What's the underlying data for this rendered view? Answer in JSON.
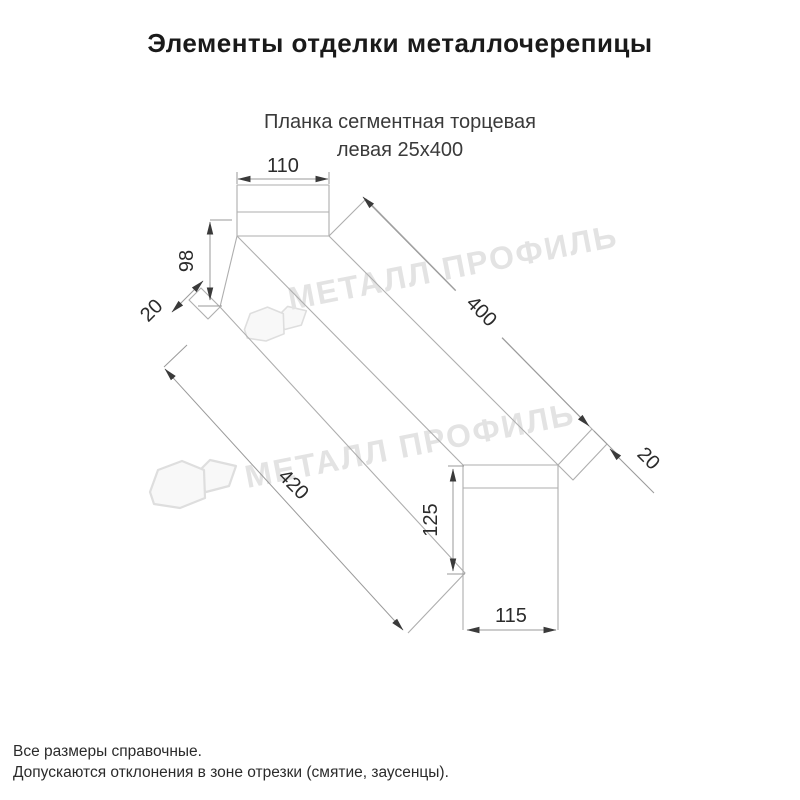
{
  "title": "Элементы отделки металлочерепицы",
  "subtitle": {
    "line1": "Планка сегментная торцевая",
    "line2": "левая 25х400"
  },
  "drawing": {
    "dimensions": {
      "top_width": "110",
      "end_height": "98",
      "near_hem": "20",
      "top_length": "400",
      "far_hem": "20",
      "bottom_length": "420",
      "segment_height": "125",
      "segment_width": "115"
    }
  },
  "watermark": {
    "text": "МЕТАЛЛ ПРОФИЛЬ"
  },
  "notes": {
    "line1": "Все размеры справочные.",
    "line2": "Допускаются отклонения в зоне отрезки (смятие, заусенцы)."
  },
  "colors": {
    "piece_line": "#aeaeae",
    "dim_line": "#9a9a9a",
    "arrow": "#3a3a3a",
    "label": "#2b2b2b",
    "watermark": "#e3e3e3"
  }
}
